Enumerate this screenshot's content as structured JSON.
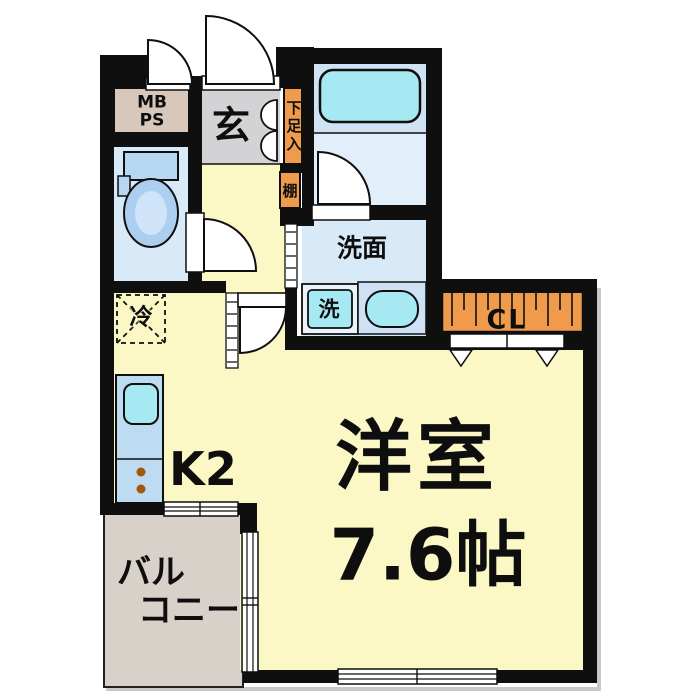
{
  "floorplan": {
    "entrance": {
      "label": "玄"
    },
    "meter_box": {
      "label": "MB\nPS"
    },
    "shoe_cabinet": {
      "label": "下足入"
    },
    "shelf": {
      "label": "棚"
    },
    "washroom": {
      "label": "洗面"
    },
    "washing_machine": {
      "label": "洗"
    },
    "refrigerator": {
      "label": "冷"
    },
    "closet": {
      "label": "CL"
    },
    "kitchen": {
      "label": "K2"
    },
    "western_room": {
      "name": "洋室",
      "size": "7.6帖"
    },
    "balcony": {
      "label_line1": "バル",
      "label_line2": "コニー"
    }
  },
  "colors": {
    "wall": "#0f0f0f",
    "room_yellow": "#fcf8c5",
    "water_blue": "#d8e9f8",
    "bath_blue": "#cfe3f5",
    "bath_lower_blue": "#e2eefa",
    "fixture_cyan": "#a7e9f2",
    "counter_blue": "#bddcf2",
    "storage_orange": "#f09b4c",
    "entrance_gray": "#d3d3d5",
    "meter_box_tan": "#d8c8bc",
    "balcony_gray": "#d8d1ca",
    "toilet_tank_blue": "#b7d6f1",
    "toilet_bowl_blue": "#accff1",
    "burner_brown": "#a2570e"
  }
}
